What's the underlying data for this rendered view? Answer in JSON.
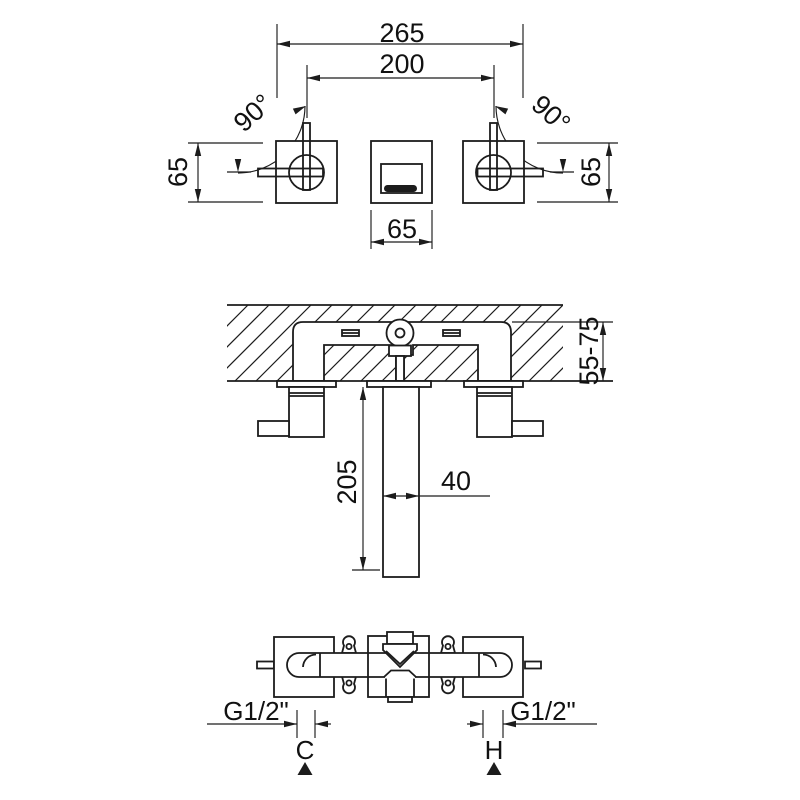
{
  "drawing": {
    "front_view": {
      "dim_overall_width": "265",
      "dim_handle_centers": "200",
      "angle_left": "90°",
      "angle_right": "90°",
      "dim_height_left": "65",
      "dim_height_right": "65",
      "dim_plate_width": "65"
    },
    "section_view": {
      "dim_wall_depth_range": "55-75",
      "dim_spout_drop": "205",
      "dim_spout_width": "40"
    },
    "plan_view": {
      "thread_left": "G1/2\"",
      "thread_right": "G1/2\"",
      "cold_label": "C",
      "hot_label": "H"
    },
    "colors": {
      "line": "#1c1c1c",
      "background": "#ffffff"
    }
  }
}
